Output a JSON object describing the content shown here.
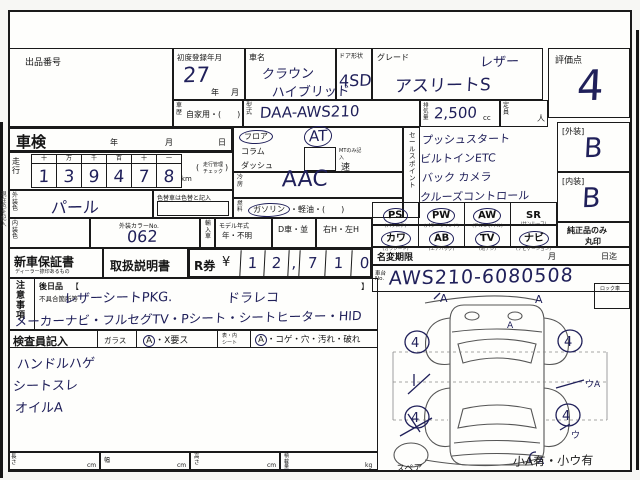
{
  "colors": {
    "ink": "#20205a",
    "line": "#1a1a1a",
    "paper": "#fefefc"
  },
  "header": {
    "auction_no_label": "出品番号",
    "first_reg": {
      "label": "初度登録年月",
      "value": "27",
      "year": "年",
      "month": "月"
    },
    "car_name": {
      "label": "車名",
      "line1": "クラウン",
      "line2": "ハイブリッド"
    },
    "doors": {
      "label": "ドア形状",
      "value": "4SD"
    },
    "grade": {
      "label": "グレード",
      "value": "アスリートS",
      "note": "レザー"
    },
    "score": {
      "label": "評価点",
      "value": "4"
    }
  },
  "spec": {
    "history": {
      "label": "車歴",
      "value": "自家用・(　　)"
    },
    "model_code": {
      "label": "型式",
      "value": "DAA-AWS210"
    },
    "displacement": {
      "label": "排気量",
      "value": "2,500",
      "unit": "cc"
    },
    "capacity": {
      "label": "定員",
      "unit": "人"
    }
  },
  "shaken": {
    "label": "車検",
    "year": "年",
    "month": "月",
    "day": "日"
  },
  "mileage": {
    "label": "走行",
    "headers": [
      "十",
      "万",
      "千",
      "百",
      "十",
      "一"
    ],
    "digits": [
      "1",
      "3",
      "9",
      "4",
      "7",
      "8"
    ],
    "unit": "km",
    "note1": "走行管理",
    "note2": "チェック"
  },
  "shift": {
    "floor": "フロア",
    "column": "コラム",
    "dash": "ダッシュ",
    "at": "AT",
    "mt_note": "MTのみ記入",
    "speed": "速"
  },
  "ac": {
    "label": "冷房",
    "value": "AAC"
  },
  "fuel": {
    "label": "燃料",
    "circled": "ガソリン",
    "rest": "・軽油・(　　)"
  },
  "sales": {
    "label": "セールスポイント",
    "lines": [
      "プッシュスタート",
      "ビルトインETC",
      "バック カメラ",
      "クルーズコントロール"
    ]
  },
  "ratings": {
    "ext_label": "[外装]",
    "ext": "B",
    "int_label": "[内装]",
    "int": "B"
  },
  "colorsec": {
    "ext_label": "外装色",
    "ext": "パール",
    "change_note": "色替車は色替と記入",
    "int_label": "内装色",
    "no_label": "外装カラーNo.",
    "no": "062",
    "import": "輸入車",
    "my_label": "モデル年式",
    "my": "年・不明",
    "dcar": "D車・並",
    "handle": "右H・左H"
  },
  "equipment": {
    "note1": "純正品のみ",
    "note2": "丸印",
    "items": [
      {
        "code": "PS",
        "sub": "(パワステ)",
        "on": true
      },
      {
        "code": "PW",
        "sub": "(パワーウインド)",
        "on": true
      },
      {
        "code": "AW",
        "sub": "(アルミホイル)",
        "on": true
      },
      {
        "code": "SR",
        "sub": "(サンルーフ)",
        "on": false
      },
      {
        "code": "カワ",
        "sub": "(カワシート)",
        "on": true
      },
      {
        "code": "AB",
        "sub": "(エアバッグ)",
        "on": true
      },
      {
        "code": "TV",
        "sub": "(地デジ)",
        "on": true
      },
      {
        "code": "ナビ",
        "sub": "(ナビゲーション)",
        "on": true
      }
    ]
  },
  "docs": {
    "warranty": "新車保証書",
    "warranty_sub": "ディーラー捺印あるもの",
    "manual": "取扱説明書",
    "rticket": "R券",
    "yen": "¥",
    "digits": [
      "1",
      "2",
      ",",
      "7",
      "1",
      "0"
    ]
  },
  "transfer": {
    "label": "名変期限",
    "month": "月",
    "until": "日迄"
  },
  "chassis": {
    "label1": "車台",
    "label2": "No.",
    "value": "AWS210-6080508"
  },
  "lock": {
    "label": "ロック車"
  },
  "notes": {
    "label": "注意事項",
    "future": "後日品",
    "b_open": "【",
    "b_close": "】",
    "defect": "不具合箇所等",
    "hw1a": "レザーシートPKG.",
    "hw1b": "ドラレコ",
    "hw2": "メーカーナビ・フルセグTV・Pシート・シートヒーター・HID"
  },
  "inspector": {
    "label": "検査員記入",
    "glass": "ガラス",
    "glass_circ": "A",
    "glass_rest": "・X要ス",
    "seat1": "表・内",
    "seat2": "シート",
    "seat_circ": "A",
    "seat_rest": "・コゲ・穴・汚れ・破れ",
    "notes": [
      "ハンドルハゲ",
      "シートスレ",
      "オイルA"
    ]
  },
  "dims": {
    "length": "長さ",
    "width": "幅",
    "height": "高さ",
    "load": "積載量",
    "cm": "cm",
    "kg": "kg"
  },
  "diagram": {
    "spare": "スペア",
    "summary": "小A有・小ウ有",
    "wheel_grades": [
      "4",
      "4",
      "4",
      "4"
    ],
    "marks": {
      "fl": "A",
      "fr": "A",
      "ws": "A",
      "side_r": "ウA",
      "rear_r": "ウ",
      "bumper": "A"
    }
  },
  "margin": {
    "left_note": "現在色を記入"
  }
}
